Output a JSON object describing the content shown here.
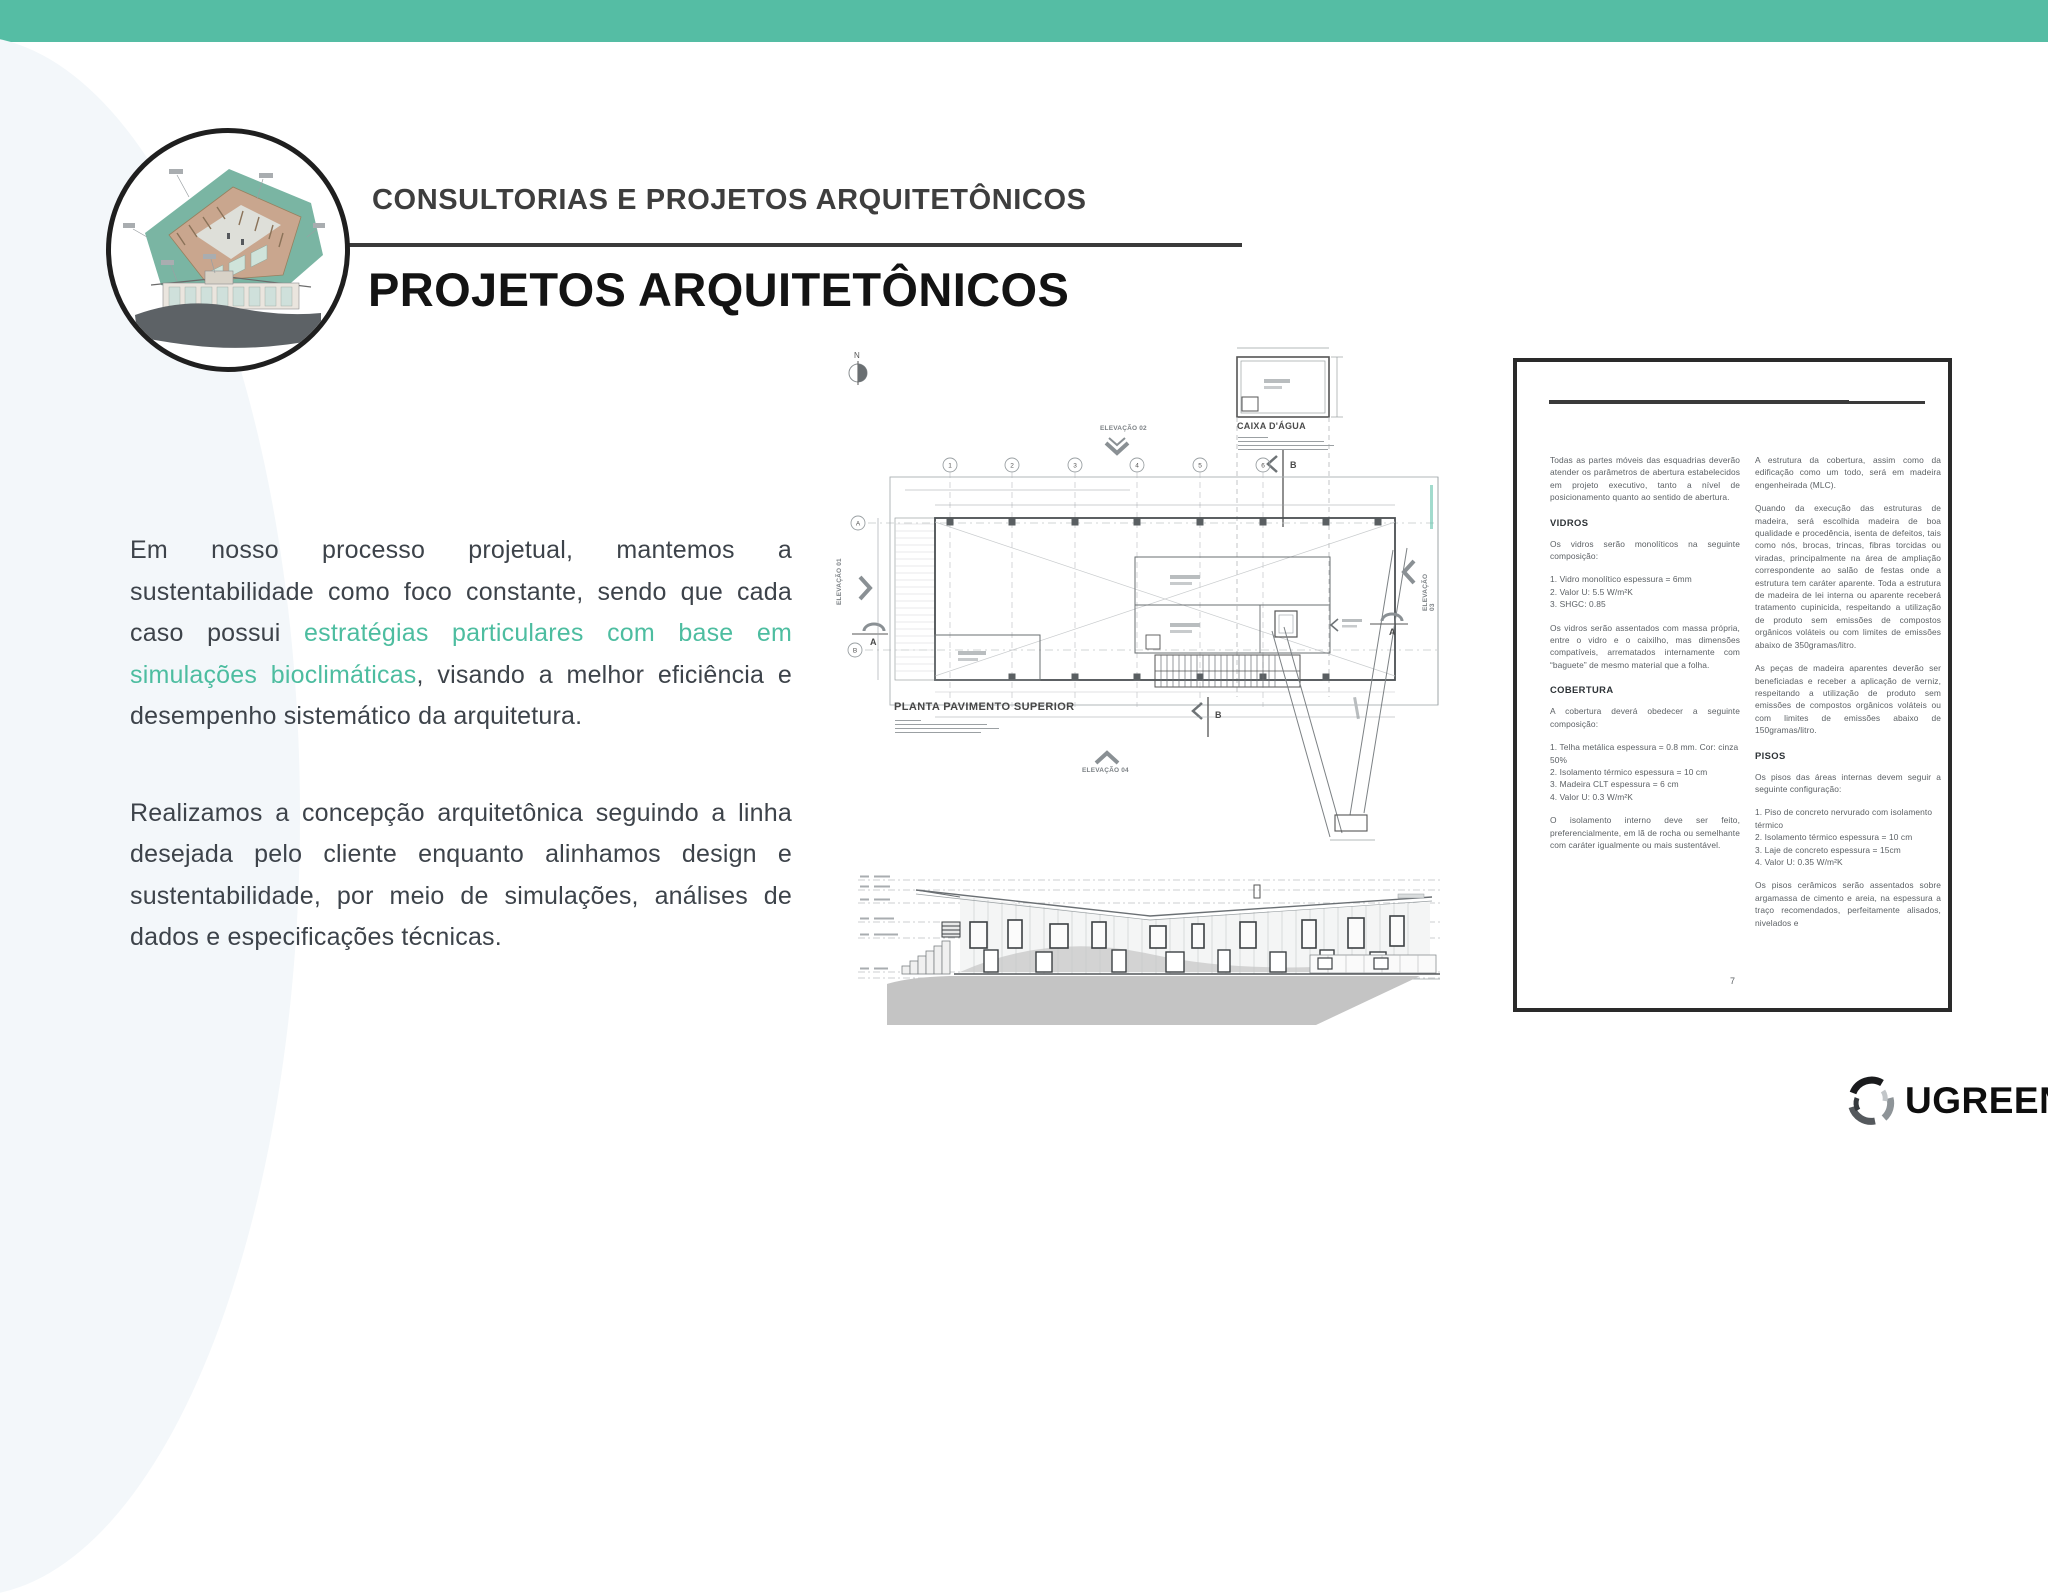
{
  "slide": {
    "kicker": "CONSULTORIAS E PROJETOS ARQUITETÔNICOS",
    "title": "PROJETOS ARQUITETÔNICOS",
    "body": {
      "p1_pre": "Em nosso processo projetual, mantemos a sustentabilidade como foco constante, sendo que cada caso possui ",
      "p1_highlight": "estratégias particulares com base em simulações bioclimáticas",
      "p1_post": ", visando a melhor eficiência e desempenho sistemático da arquitetura.",
      "p2": "Realizamos a concepção arquitetônica seguindo a linha desejada pelo cliente enquanto alinhamos design e sustentabilidade, por meio de simulações, análises de dados e especificações técnicas."
    },
    "colors": {
      "top_bar": "#55bda4",
      "highlight_text": "#4dbda0"
    }
  },
  "plan": {
    "north_label": "N",
    "caixa_dagua_label": "CAIXA D'ÁGUA",
    "title": "PLANTA PAVIMENTO SUPERIOR",
    "elevation_01": "ELEVAÇÃO 01",
    "elevation_02": "ELEVAÇÃO 02",
    "elevation_03": "ELEVAÇÃO 03",
    "elevation_04": "ELEVAÇÃO 04",
    "grid_numbers": [
      "1",
      "2",
      "3",
      "4",
      "5",
      "6"
    ],
    "row_letters": [
      "A",
      "B"
    ],
    "section_a": "A",
    "section_b": "B"
  },
  "doc": {
    "left_col": [
      {
        "type": "p",
        "text": "Todas as partes móveis das esquadrias deverão atender os parâmetros de abertura estabelecidos em projeto executivo, tanto a nível de posicionamento quanto ao sentido de abertura."
      },
      {
        "type": "h",
        "text": "VIDROS"
      },
      {
        "type": "p",
        "text": "Os vidros serão monolíticos na seguinte composição:"
      },
      {
        "type": "list",
        "text": "1. Vidro monolítico espessura = 6mm\n2. Valor U: 5.5 W/m²K\n3. SHGC: 0.85"
      },
      {
        "type": "p",
        "text": "Os vidros serão assentados com massa própria, entre o vidro e o caixilho, mas dimensões compatíveis, arrematados internamente com “baguete” de mesmo material que a folha."
      },
      {
        "type": "h",
        "text": "COBERTURA"
      },
      {
        "type": "p",
        "text": "A cobertura deverá obedecer a seguinte composição:"
      },
      {
        "type": "list",
        "text": "1. Telha metálica espessura = 0.8 mm. Cor: cinza 50%\n2. Isolamento térmico espessura = 10 cm\n3. Madeira CLT espessura = 6 cm\n4. Valor U: 0.3 W/m²K"
      },
      {
        "type": "p",
        "text": "O isolamento interno deve ser feito, preferencialmente, em lã de rocha ou semelhante com caráter igualmente ou mais sustentável."
      }
    ],
    "right_col": [
      {
        "type": "p",
        "text": "A estrutura da cobertura, assim como da edificação como um todo, será em madeira engenheirada (MLC)."
      },
      {
        "type": "p",
        "text": "Quando da execução das estruturas de madeira, será escolhida madeira de boa qualidade e procedência, isenta de defeitos, tais como nós, brocas, trincas, fibras torcidas ou viradas, principalmente na área de ampliação correspondente ao salão de festas onde a estrutura tem caráter aparente. Toda a estrutura de madeira de lei interna ou aparente receberá tratamento cupinicida, respeitando a utilização de produto sem emissões de compostos orgânicos voláteis ou com limites de emissões abaixo de 350gramas/litro."
      },
      {
        "type": "p",
        "text": "As peças de madeira aparentes deverão ser beneficiadas e receber a aplicação de verniz, respeitando a utilização de produto sem emissões de compostos orgânicos voláteis ou com limites de emissões abaixo de 150gramas/litro."
      },
      {
        "type": "h",
        "text": "PISOS"
      },
      {
        "type": "p",
        "text": "Os pisos das áreas internas devem seguir a seguinte configuração:"
      },
      {
        "type": "list",
        "text": "1. Piso de concreto nervurado com isolamento térmico\n2. Isolamento térmico espessura = 10 cm\n3. Laje de concreto espessura = 15cm\n4. Valor U: 0.35 W/m²K"
      },
      {
        "type": "p",
        "text": "Os pisos cerâmicos serão assentados sobre argamassa de cimento e areia, na espessura a traço recomendados, perfeitamente alisados, nivelados e"
      }
    ],
    "page_number": "7"
  },
  "footer": {
    "brand": "UGREEN"
  }
}
